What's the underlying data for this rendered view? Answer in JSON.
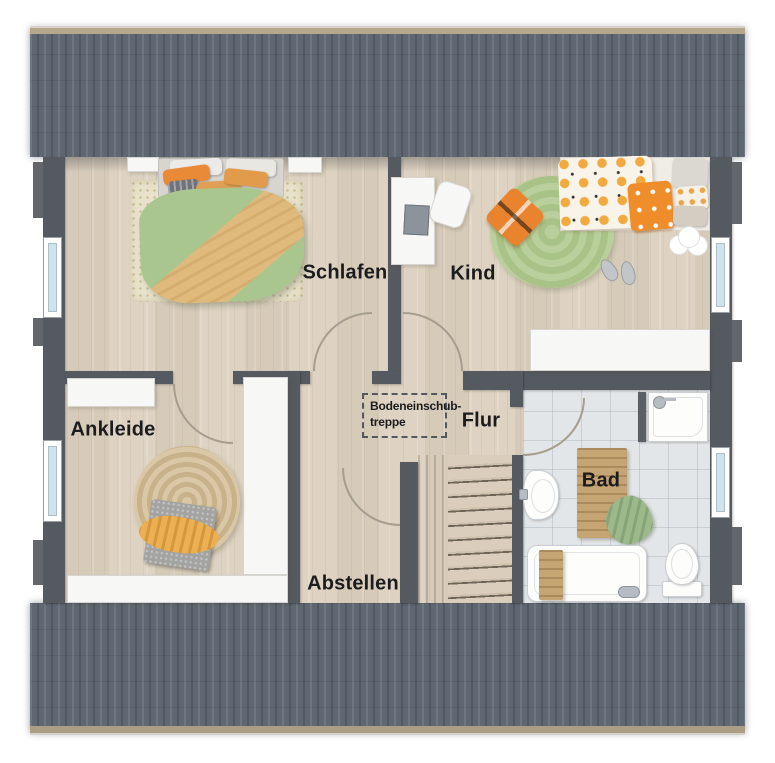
{
  "rooms": {
    "schlafen": {
      "label": "Schlafen"
    },
    "kind": {
      "label": "Kind"
    },
    "ankleide": {
      "label": "Ankleide"
    },
    "flur": {
      "label": "Flur"
    },
    "bad": {
      "label": "Bad"
    },
    "abstellen": {
      "label": "Abstellen"
    }
  },
  "annotations": {
    "bodeneinschubtreppe": {
      "line1": "Bodeneinschub-",
      "line2": "treppe"
    }
  },
  "colors": {
    "roof": "#5f6772",
    "wall": "#555a60",
    "floor_wood": "#ddd1bf",
    "bath_tile": "#e3e6e8",
    "accent_orange": "#e98a36",
    "accent_green": "#a9c68e",
    "window_glass": "#cfe3ee"
  }
}
